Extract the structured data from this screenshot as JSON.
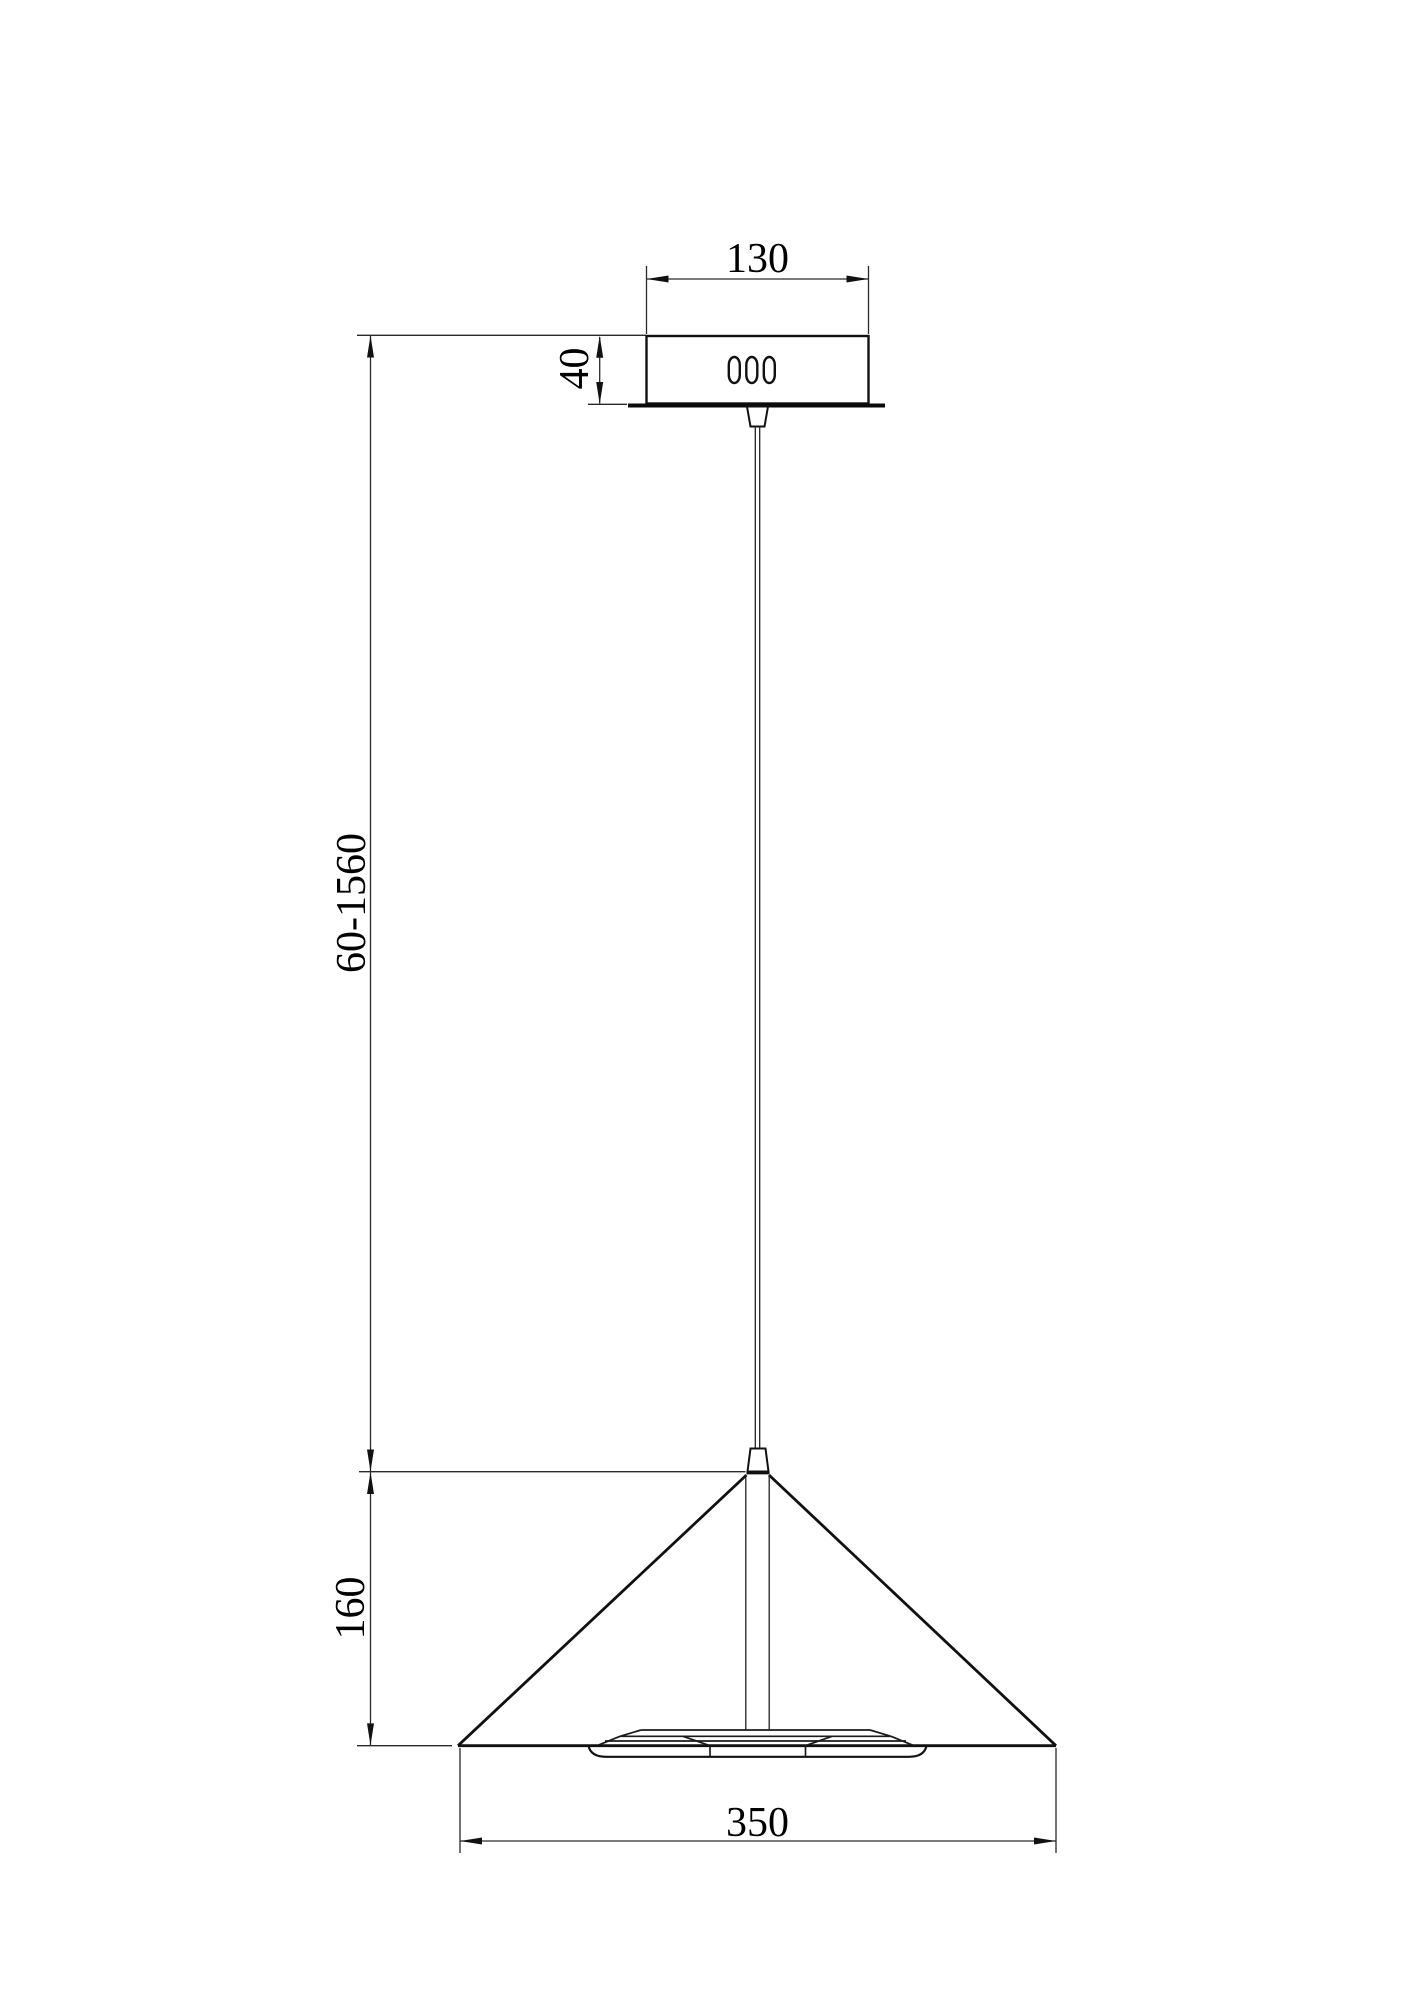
{
  "page": {
    "background": "#ffffff",
    "line_color": "#000000"
  },
  "drawing": {
    "dims": {
      "canopy_width": "130",
      "canopy_height": "40",
      "suspension_length_range": "60-1560",
      "shade_height": "160",
      "shade_diameter": "350"
    }
  }
}
